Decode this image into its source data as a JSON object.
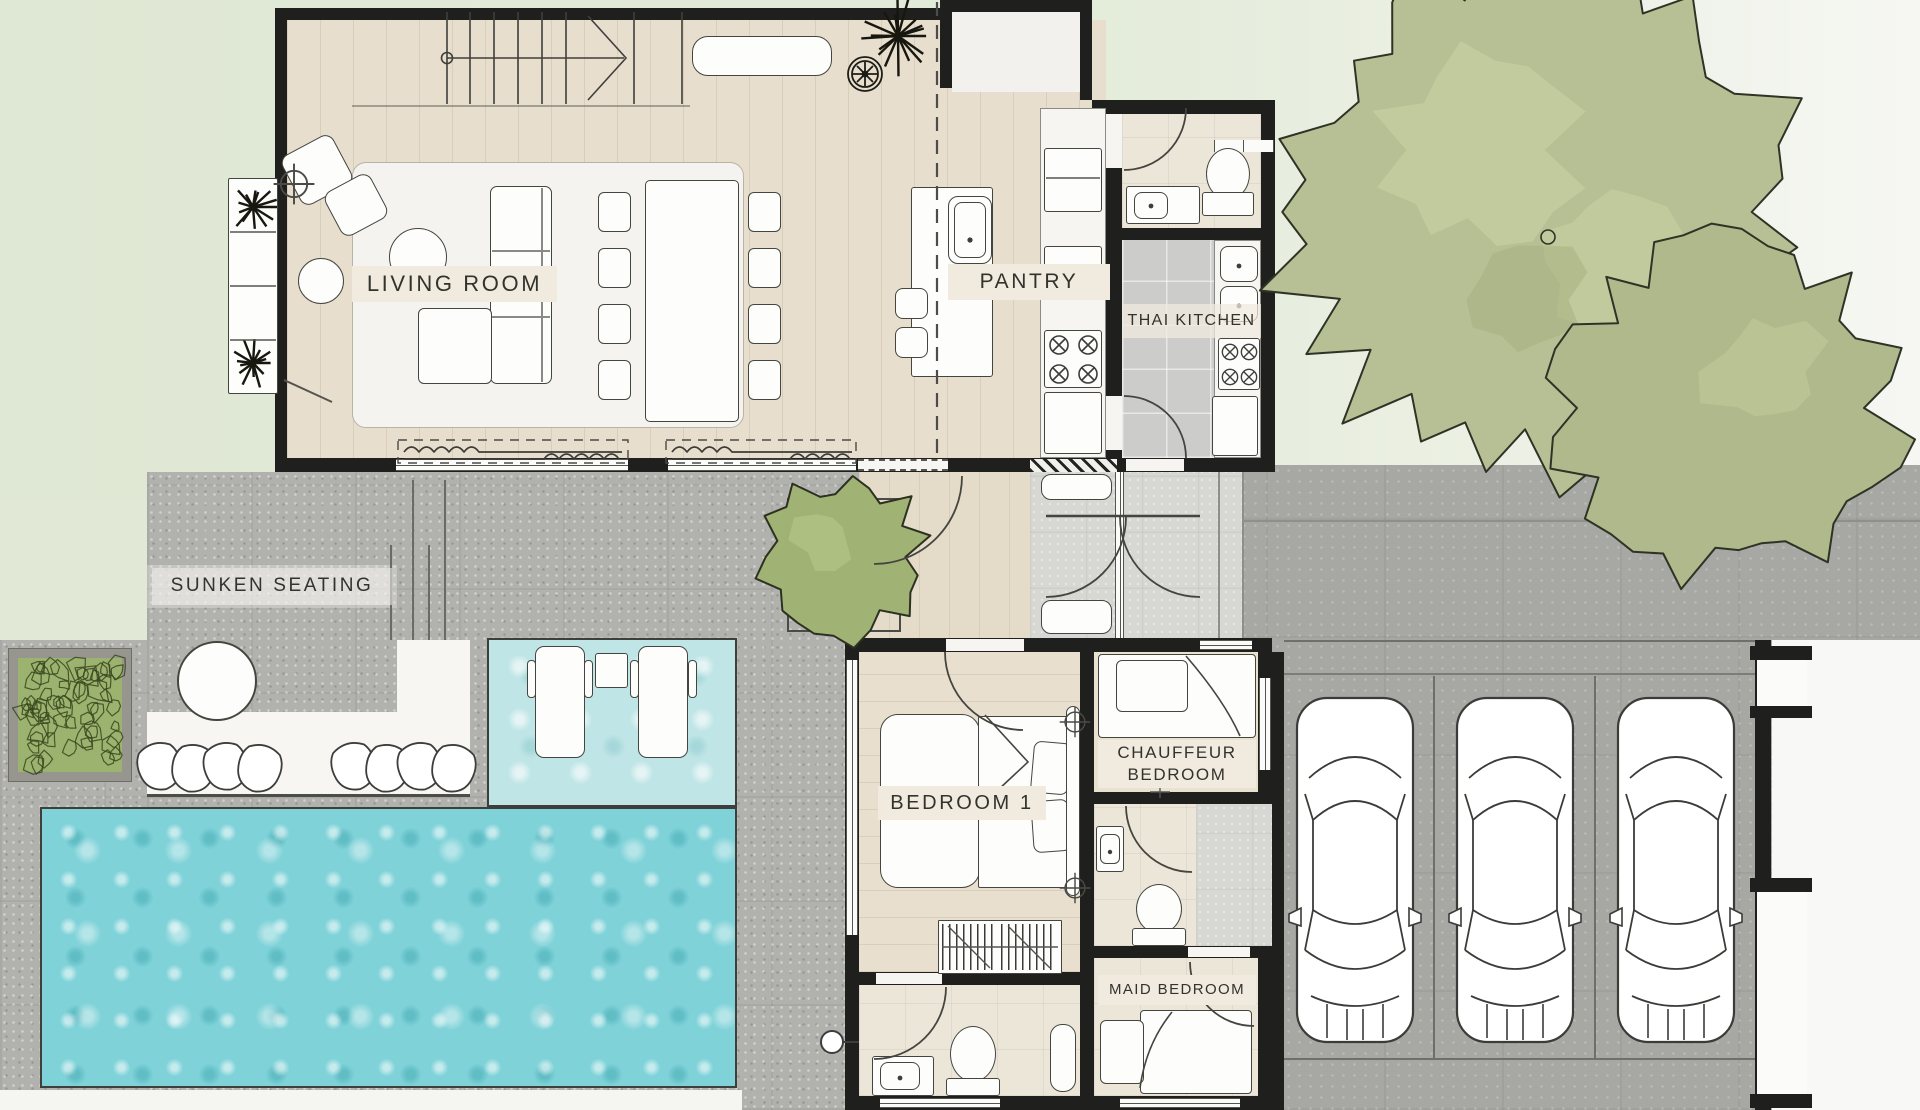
{
  "colors": {
    "wall": "#1f1f1d",
    "ink": "#33332e",
    "wood": "#e7decd",
    "wood2": "#e8dfcf",
    "woodhall": "#e4dbc9",
    "cream": "#ece6d9",
    "creamwarm": "#eae2d1",
    "tile": "#cccccb",
    "court": "#d7d7d3",
    "terrace": "#b1b1ad",
    "drive": "#a7a7a4",
    "pool": "#7ed2d8",
    "shelf": "#bfe5e6",
    "garden": "#e3ebd8",
    "tree": "#b7c094",
    "tree2": "#afb98c",
    "tree3": "#a0b274",
    "hedge": "#9cb36f",
    "labelbg": "#f0eadf",
    "white": "#fbfbf9"
  },
  "rooms": {
    "living_room": {
      "label": "LIVING ROOM"
    },
    "pantry": {
      "label": "PANTRY"
    },
    "thai_kitchen": {
      "label": "THAI KITCHEN"
    },
    "sunken_seating": {
      "label": "SUNKEN SEATING"
    },
    "bedroom_1": {
      "label": "BEDROOM 1"
    },
    "chauffeur_bedroom": {
      "label": "CHAUFFEUR BEDROOM"
    },
    "maid_bedroom": {
      "label": "MAID BEDROOM"
    }
  }
}
